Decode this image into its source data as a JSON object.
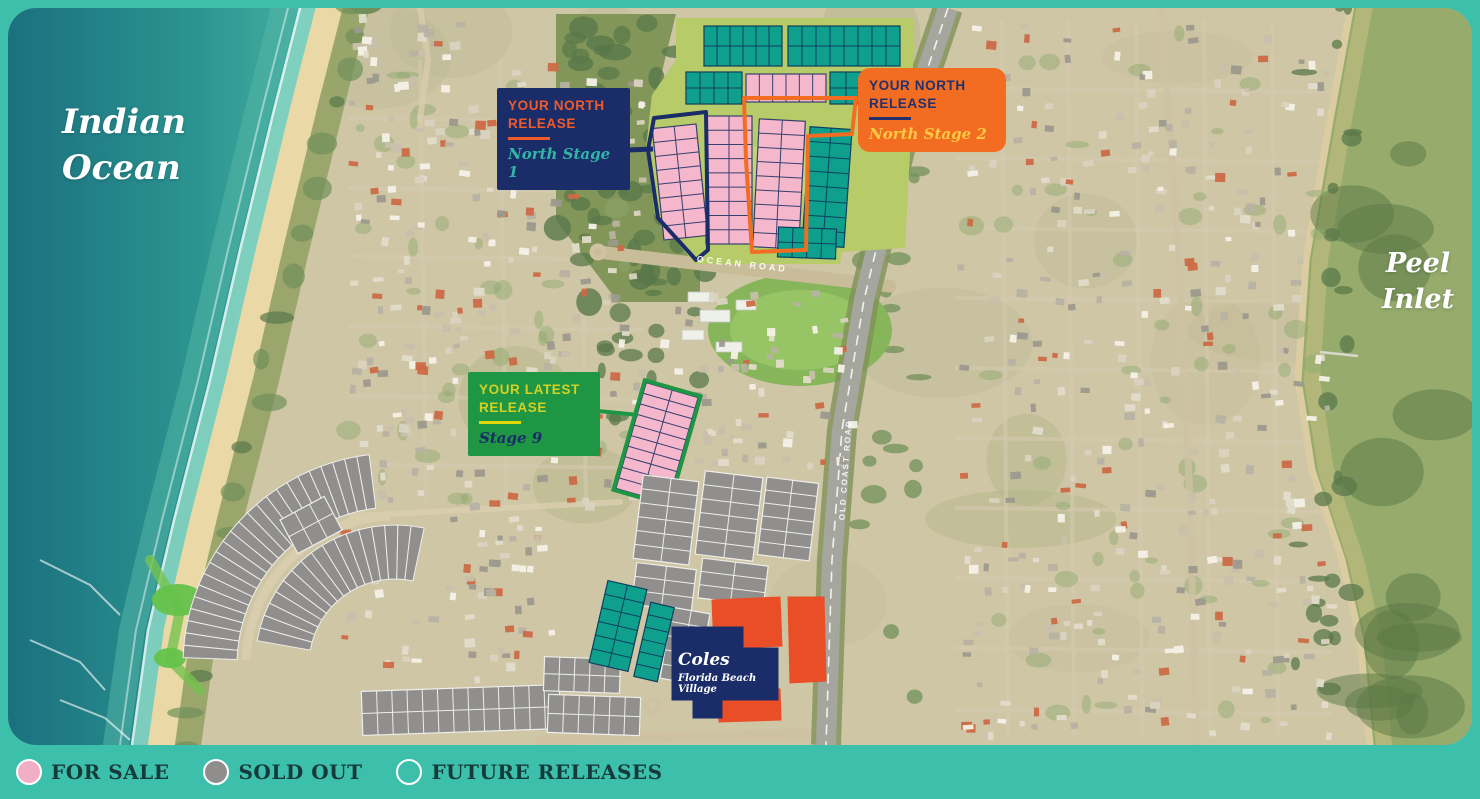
{
  "page": {
    "background": "#3cc0ab"
  },
  "map": {
    "water_labels": {
      "ocean": {
        "lines": [
          "Indian",
          "Ocean"
        ]
      },
      "inlet": {
        "lines": [
          "Peel",
          "Inlet"
        ]
      }
    },
    "road_labels": [
      {
        "text": "OCEAN ROAD",
        "x": 742,
        "y": 267,
        "rot": 6.5,
        "size": 9,
        "ls": 3
      },
      {
        "text": "OLD COAST ROAD",
        "x": 848,
        "y": 470,
        "rot": -86,
        "size": 8,
        "ls": 2
      }
    ],
    "callouts": [
      {
        "id": "north-stage-1",
        "x": 497,
        "y": 88,
        "w": 133,
        "h": 72,
        "radius": 2,
        "bg": "#1b2d69",
        "title": "YOUR NORTH RELEASE",
        "title_color": "#f15a29",
        "rule_color": "#f15a29",
        "subtitle": "North Stage 1",
        "subtitle_color": "#2fb7a6"
      },
      {
        "id": "north-stage-2",
        "x": 858,
        "y": 68,
        "w": 148,
        "h": 77,
        "radius": 12,
        "bg": "#f26d21",
        "title": "YOUR NORTH RELEASE",
        "title_color": "#24306b",
        "rule_color": "#24306b",
        "subtitle": "North Stage 2",
        "subtitle_color": "#ffc845"
      },
      {
        "id": "stage-9",
        "x": 468,
        "y": 372,
        "w": 132,
        "h": 80,
        "radius": 2,
        "bg": "#1e9644",
        "title": "YOUR LATEST RELEASE",
        "title_color": "#d4d123",
        "rule_color": "#e3d800",
        "subtitle": "Stage 9",
        "subtitle_color": "#1b2d69"
      }
    ],
    "store_label": {
      "name": "Coles",
      "tagline": "Florida Beach Village"
    },
    "statuses": {
      "for_sale": {
        "fill": "#F5B7CC",
        "stroke": "#35406f"
      },
      "future": {
        "fill": "#0FA08D",
        "stroke": "#0d3f5f"
      },
      "sold": {
        "fill": "#908F8D",
        "stroke": "#EDEDEA"
      },
      "commercial": {
        "fill": "#E94E27",
        "stroke": "#E94E27"
      },
      "store": {
        "fill": "#1B2D69",
        "stroke": "#1B2D69"
      }
    },
    "coast": {
      "beach_pts": [
        [
          326,
          0
        ],
        [
          318,
          8
        ],
        [
          292,
          110
        ],
        [
          258,
          250
        ],
        [
          228,
          380
        ],
        [
          192,
          520
        ],
        [
          166,
          630
        ],
        [
          150,
          745
        ],
        [
          148,
          799
        ]
      ],
      "inlet_pts": [
        [
          1352,
          0
        ],
        [
          1330,
          120
        ],
        [
          1306,
          260
        ],
        [
          1298,
          380
        ],
        [
          1312,
          470
        ],
        [
          1342,
          560
        ],
        [
          1360,
          640
        ],
        [
          1370,
          745
        ],
        [
          1374,
          799
        ]
      ]
    },
    "regions": [
      {
        "t": "poly",
        "fill": "#b7cb69",
        "pts": [
          [
            676,
            18
          ],
          [
            913,
            18
          ],
          [
            913,
            95
          ],
          [
            905,
            248
          ],
          [
            842,
            252
          ],
          [
            840,
            264
          ],
          [
            695,
            264
          ],
          [
            655,
            215
          ],
          [
            646,
            148
          ],
          [
            652,
            95
          ],
          [
            676,
            60
          ]
        ]
      },
      {
        "t": "poly",
        "fill": "#c3d474",
        "pts": [
          [
            752,
            146
          ],
          [
            806,
            146
          ],
          [
            810,
            194
          ],
          [
            754,
            196
          ]
        ]
      },
      {
        "t": "grid",
        "s": "future",
        "x": 704,
        "y": 26,
        "w": 78,
        "h": 40,
        "cols": 6,
        "rows": 2
      },
      {
        "t": "grid",
        "s": "future",
        "x": 788,
        "y": 26,
        "w": 112,
        "h": 40,
        "cols": 8,
        "rows": 2
      },
      {
        "t": "grid",
        "s": "future",
        "x": 686,
        "y": 72,
        "w": 56,
        "h": 32,
        "cols": 4,
        "rows": 2
      },
      {
        "t": "grid",
        "s": "future",
        "x": 830,
        "y": 72,
        "w": 64,
        "h": 32,
        "cols": 4,
        "rows": 2
      },
      {
        "t": "grid",
        "s": "for_sale",
        "x": 746,
        "y": 74,
        "w": 80,
        "h": 28,
        "cols": 6,
        "rows": 1
      },
      {
        "t": "grid",
        "s": "for_sale",
        "x": 658,
        "y": 126,
        "w": 44,
        "h": 112,
        "cols": 2,
        "rows": 8,
        "angle": -6
      },
      {
        "t": "grid",
        "s": "for_sale",
        "x": 706,
        "y": 116,
        "w": 46,
        "h": 128,
        "cols": 2,
        "rows": 9
      },
      {
        "t": "grid",
        "s": "for_sale",
        "x": 756,
        "y": 120,
        "w": 46,
        "h": 128,
        "cols": 2,
        "rows": 9,
        "angle": 3
      },
      {
        "t": "grid",
        "s": "future",
        "x": 806,
        "y": 128,
        "w": 42,
        "h": 118,
        "cols": 2,
        "rows": 8,
        "angle": 4
      },
      {
        "t": "grid",
        "s": "future",
        "x": 778,
        "y": 228,
        "w": 58,
        "h": 30,
        "cols": 4,
        "rows": 2,
        "angle": 2
      },
      {
        "t": "outline",
        "color": "#1b2d69",
        "w": 4,
        "close": true,
        "pts": [
          [
            654,
            118
          ],
          [
            706,
            112
          ],
          [
            708,
            250
          ],
          [
            696,
            260
          ],
          [
            658,
            218
          ],
          [
            648,
            150
          ]
        ]
      },
      {
        "t": "line",
        "color": "#1b2d69",
        "w": 5,
        "x1": 628,
        "y1": 150,
        "x2": 653,
        "y2": 149
      },
      {
        "t": "outline",
        "color": "#f26d21",
        "w": 4,
        "close": true,
        "pts": [
          [
            744,
            98
          ],
          [
            856,
            98
          ],
          [
            852,
            134
          ],
          [
            808,
            136
          ],
          [
            806,
            250
          ],
          [
            752,
            252
          ],
          [
            746,
            160
          ]
        ]
      },
      {
        "t": "grid",
        "s": "for_sale",
        "x": 630,
        "y": 388,
        "w": 54,
        "h": 110,
        "cols": 2,
        "rows": 10,
        "angle": 16,
        "outline": {
          "color": "#1e9644",
          "w": 4
        }
      },
      {
        "t": "line",
        "color": "#1e9644",
        "w": 4,
        "x1": 598,
        "y1": 411,
        "x2": 638,
        "y2": 415
      },
      {
        "t": "arc",
        "s": "sold",
        "cx": 395,
        "cy": 665,
        "r0": 158,
        "r1": 212,
        "a0": -178,
        "a1": -97,
        "n": 24
      },
      {
        "t": "arc",
        "s": "sold",
        "cx": 395,
        "cy": 665,
        "r0": 86,
        "r1": 140,
        "a0": -170,
        "a1": -78,
        "n": 17
      },
      {
        "t": "arcline",
        "color": "#d8cdad",
        "w": 9,
        "cx": 395,
        "cy": 665,
        "r": 149,
        "a0": -178,
        "a1": -92
      },
      {
        "t": "grid",
        "s": "sold",
        "x": 362,
        "y": 688,
        "w": 198,
        "h": 44,
        "cols": 13,
        "rows": 2,
        "angle": -2
      },
      {
        "t": "grid",
        "s": "sold",
        "x": 286,
        "y": 506,
        "w": 50,
        "h": 38,
        "cols": 3,
        "rows": 2,
        "angle": -28
      },
      {
        "t": "grid",
        "s": "sold",
        "x": 638,
        "y": 478,
        "w": 56,
        "h": 84,
        "cols": 2,
        "rows": 6,
        "angle": 7
      },
      {
        "t": "grid",
        "s": "sold",
        "x": 700,
        "y": 474,
        "w": 58,
        "h": 84,
        "cols": 2,
        "rows": 6,
        "angle": 7
      },
      {
        "t": "grid",
        "s": "sold",
        "x": 762,
        "y": 480,
        "w": 52,
        "h": 78,
        "cols": 2,
        "rows": 6,
        "angle": 7
      },
      {
        "t": "grid",
        "s": "sold",
        "x": 634,
        "y": 566,
        "w": 60,
        "h": 42,
        "cols": 2,
        "rows": 3,
        "angle": 7
      },
      {
        "t": "grid",
        "s": "sold",
        "x": 700,
        "y": 562,
        "w": 66,
        "h": 40,
        "cols": 2,
        "rows": 3,
        "angle": 7
      },
      {
        "t": "grid",
        "s": "sold",
        "x": 666,
        "y": 610,
        "w": 38,
        "h": 72,
        "cols": 2,
        "rows": 5,
        "angle": 10
      },
      {
        "t": "grid",
        "s": "sold",
        "x": 544,
        "y": 658,
        "w": 76,
        "h": 34,
        "cols": 5,
        "rows": 2,
        "angle": 2
      },
      {
        "t": "grid",
        "s": "sold",
        "x": 548,
        "y": 696,
        "w": 92,
        "h": 38,
        "cols": 6,
        "rows": 2,
        "angle": 2
      },
      {
        "t": "grid",
        "s": "future",
        "x": 598,
        "y": 584,
        "w": 40,
        "h": 84,
        "cols": 2,
        "rows": 6,
        "angle": 13
      },
      {
        "t": "grid",
        "s": "future",
        "x": 642,
        "y": 604,
        "w": 24,
        "h": 76,
        "cols": 1,
        "rows": 6,
        "angle": 13
      },
      {
        "t": "poly",
        "s": "commercial",
        "pts": [
          [
            712,
            600
          ],
          [
            780,
            597
          ],
          [
            782,
            646
          ],
          [
            714,
            649
          ]
        ]
      },
      {
        "t": "poly",
        "s": "commercial",
        "pts": [
          [
            788,
            597
          ],
          [
            824,
            597
          ],
          [
            826,
            681
          ],
          [
            790,
            683
          ]
        ]
      },
      {
        "t": "poly",
        "s": "commercial",
        "pts": [
          [
            718,
            691
          ],
          [
            780,
            689
          ],
          [
            781,
            720
          ],
          [
            719,
            722
          ]
        ]
      },
      {
        "t": "poly",
        "s": "store",
        "pts": [
          [
            672,
            627
          ],
          [
            743,
            627
          ],
          [
            743,
            648
          ],
          [
            778,
            648
          ],
          [
            778,
            700
          ],
          [
            722,
            700
          ],
          [
            722,
            718
          ],
          [
            693,
            718
          ],
          [
            693,
            700
          ],
          [
            672,
            700
          ]
        ]
      }
    ],
    "bush": {
      "pts": [
        [
          556,
          14
        ],
        [
          676,
          14
        ],
        [
          660,
          80
        ],
        [
          648,
          150
        ],
        [
          656,
          215
        ],
        [
          700,
          264
        ],
        [
          700,
          302
        ],
        [
          618,
          302
        ],
        [
          556,
          220
        ]
      ],
      "fill": "#7e9355"
    },
    "features": {
      "oval": {
        "cx": 800,
        "cy": 330,
        "rx": 92,
        "ry": 56,
        "fill": "#86b55a",
        "inner": "#97c465"
      },
      "school_buildings": [
        [
          688,
          292,
          26,
          10
        ],
        [
          700,
          310,
          30,
          12
        ],
        [
          682,
          330,
          22,
          10
        ],
        [
          716,
          342,
          26,
          10
        ],
        [
          736,
          300,
          20,
          10
        ]
      ],
      "golf_greens": [
        [
          178,
          600,
          26,
          16
        ],
        [
          205,
          640,
          20,
          12
        ],
        [
          170,
          658,
          16,
          10
        ]
      ]
    },
    "roads": [
      {
        "pts": [
          [
            598,
            252
          ],
          [
            890,
            286
          ]
        ],
        "w": 13,
        "color": "#c9bc98"
      },
      {
        "pts": [
          [
            1162,
            8
          ],
          [
            1178,
            250
          ],
          [
            1190,
            500
          ],
          [
            1196,
            745
          ]
        ],
        "w": 7,
        "color": "#cdc2a4",
        "o": 0.8
      },
      {
        "pts": [
          [
            540,
            740
          ],
          [
            830,
            733
          ]
        ],
        "w": 10,
        "color": "#cfc2a2"
      },
      {
        "pts": [
          [
            352,
            516
          ],
          [
            620,
            502
          ]
        ],
        "w": 6,
        "color": "#d8cdad",
        "o": 0.9
      },
      {
        "pts": [
          [
            420,
            8
          ],
          [
            428,
            60
          ],
          [
            420,
            120
          ]
        ],
        "w": 6,
        "color": "#d8cdad",
        "o": 0.8
      }
    ],
    "highway": {
      "pts": [
        [
          948,
          8
        ],
        [
          900,
          150
        ],
        [
          864,
          300
        ],
        [
          842,
          430
        ],
        [
          832,
          560
        ],
        [
          826,
          745
        ]
      ],
      "w": 20,
      "color": "#a5a69e",
      "verge": "#7f9159"
    },
    "road_grids": [
      {
        "vx": [
          1002,
          1068,
          1136,
          1204,
          1272
        ],
        "hy": [
          88,
          158,
          228,
          298,
          368,
          438,
          508,
          578,
          648,
          710
        ],
        "x0": 955,
        "x1": 1332,
        "y0": 20,
        "y1": 735,
        "w": 4,
        "color": "#d6cbb0",
        "o": 0.55
      },
      {
        "vx": [
          420,
          500,
          580
        ],
        "hy": [
          118,
          188,
          256,
          326,
          396,
          464
        ],
        "x0": 348,
        "x1": 644,
        "y0": 60,
        "y1": 505,
        "w": 4,
        "color": "#d6cbb0",
        "o": 0.55
      }
    ],
    "roundabouts": [
      [
        652,
        706
      ],
      [
        598,
        252
      ]
    ],
    "house_zones": [
      {
        "x": 348,
        "y": 60,
        "w": 292,
        "h": 445,
        "n": 240
      },
      {
        "x": 330,
        "y": 515,
        "w": 220,
        "h": 150,
        "n": 45
      },
      {
        "x": 650,
        "y": 288,
        "w": 200,
        "h": 180,
        "n": 70
      },
      {
        "x": 955,
        "y": 20,
        "w": 372,
        "h": 715,
        "n": 330
      },
      {
        "x": 352,
        "y": 14,
        "w": 116,
        "h": 44,
        "n": 18
      },
      {
        "x": 472,
        "y": 516,
        "w": 70,
        "h": 210,
        "n": 28
      }
    ],
    "veg_zones": [
      {
        "x": 556,
        "y": 14,
        "w": 140,
        "h": 290,
        "n": 26,
        "c": "dark"
      },
      {
        "x": 600,
        "y": 250,
        "w": 110,
        "h": 170,
        "n": 16,
        "c": "dark"
      },
      {
        "x": 1295,
        "y": 8,
        "w": 58,
        "h": 720,
        "n": 26,
        "c": "dark"
      },
      {
        "x": 850,
        "y": 8,
        "w": 70,
        "h": 730,
        "n": 22,
        "c": "mid"
      },
      {
        "x": 348,
        "y": 60,
        "w": 290,
        "h": 440,
        "n": 40,
        "c": "soft"
      },
      {
        "x": 955,
        "y": 20,
        "w": 370,
        "h": 715,
        "n": 55,
        "c": "soft"
      }
    ]
  },
  "legend": {
    "items": [
      {
        "label": "FOR SALE",
        "fill": "#f2aec5",
        "stroke": "#ffffff"
      },
      {
        "label": "SOLD OUT",
        "fill": "#8f8e8c",
        "stroke": "#ffffff"
      },
      {
        "label": "FUTURE RELEASES",
        "fill": "transparent",
        "stroke": "#ffffff"
      }
    ]
  }
}
